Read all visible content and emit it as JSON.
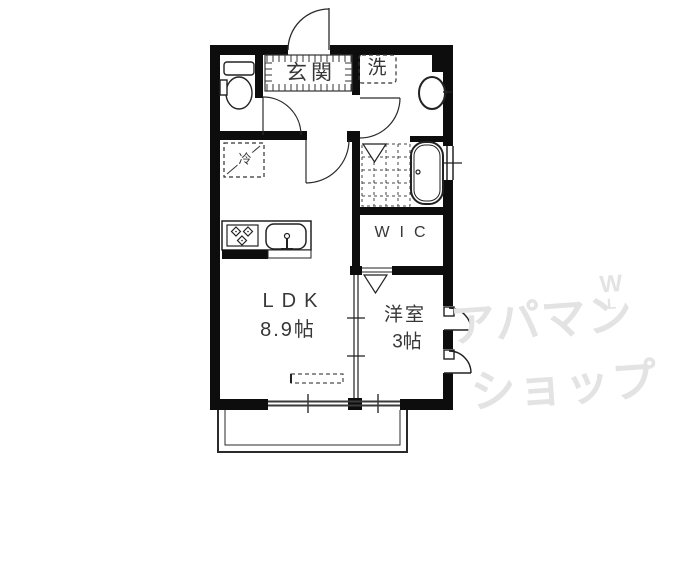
{
  "rooms": {
    "genkan": {
      "label": "玄関"
    },
    "laundry": {
      "label": "洗"
    },
    "refrigerator": {
      "label": "冷"
    },
    "wic": {
      "label": "WIC"
    },
    "ldk": {
      "label": "LDK",
      "size": "8.9帖"
    },
    "western_room": {
      "label": "洋室",
      "size": "3帖"
    }
  },
  "watermark": {
    "line1": "アパマン",
    "line2": "ショップ",
    "mark": "W",
    "mark_sub": "L"
  },
  "icons": {
    "toilet": "toilet-icon",
    "washbasin": "washbasin-icon",
    "bathtub": "bathtub-icon",
    "stove": "stove-icon",
    "kitchen_sink": "kitchen-sink-icon",
    "entrance_door": "entrance-door-arc",
    "folding_door": "folding-door-icon",
    "sliding_window": "sliding-window-icon",
    "balcony": "balcony-outline"
  },
  "colors": {
    "wall": "#0d0d0d",
    "line": "#2b2b2b",
    "label": "#373737",
    "watermark": "#e3e3e3",
    "background": "#ffffff"
  }
}
